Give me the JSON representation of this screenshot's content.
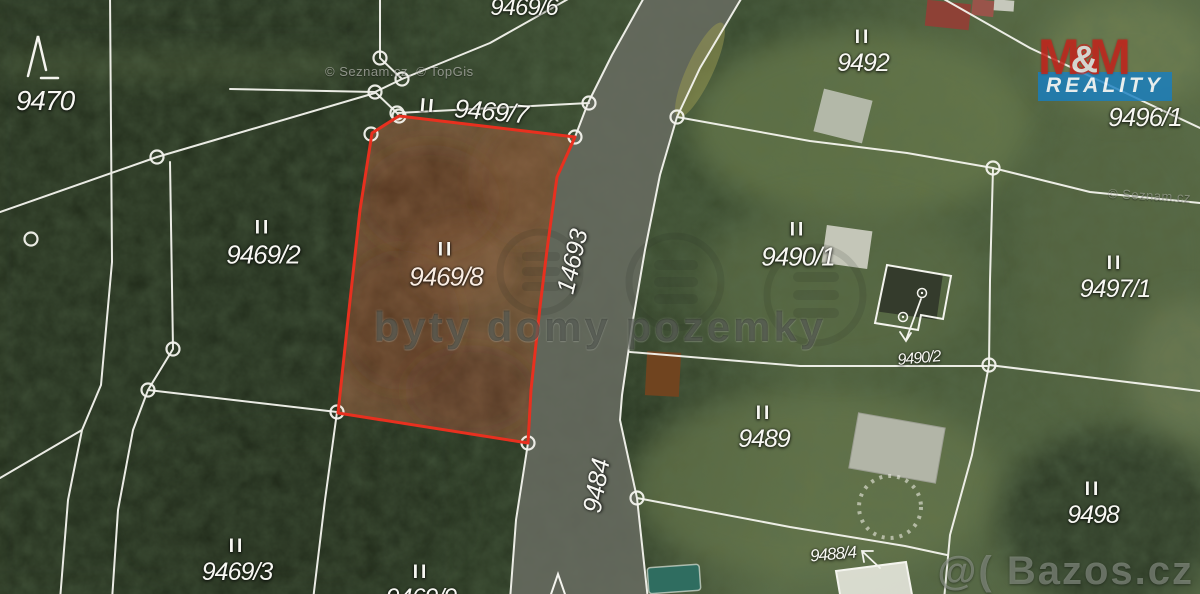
{
  "map": {
    "type": "cadastral-aerial-photo",
    "attribution_left": "© Seznam.cz, © TopGis",
    "attribution_right": "© Seznam.cz",
    "center_watermark": "byty domy pozemky",
    "corner_watermark": "@( Bazos.cz",
    "logo": {
      "m_left": "M",
      "ampersand": "&",
      "m_right": "M",
      "banner": "REALITY"
    },
    "colors": {
      "highlight_stroke": "#e8301f",
      "highlight_fill": "rgba(130,82,52,0.6)",
      "boundary_line": "#f4f4ee",
      "road_surface": "#686c62",
      "logo_red": "#c6241c",
      "logo_blue": "#177ec1"
    },
    "road_labels": [
      {
        "text": "14693"
      },
      {
        "text": "9484"
      }
    ],
    "labels": [
      {
        "marker": "",
        "text": "9470"
      },
      {
        "marker": "",
        "text": "9469/6"
      },
      {
        "marker": "II",
        "text": "9469/7"
      },
      {
        "marker": "II",
        "text": "9469/2"
      },
      {
        "marker": "II",
        "text": "9469/8",
        "highlighted": true
      },
      {
        "marker": "II",
        "text": "9492"
      },
      {
        "marker": "",
        "text": "9496/1"
      },
      {
        "marker": "II",
        "text": "9490/1"
      },
      {
        "marker": "II",
        "text": "9497/1"
      },
      {
        "marker": "",
        "text": "9490/2"
      },
      {
        "marker": "II",
        "text": "9489"
      },
      {
        "marker": "II",
        "text": "9498"
      },
      {
        "marker": "",
        "text": "9488/4"
      },
      {
        "marker": "II",
        "text": "9469/3"
      },
      {
        "marker": "II",
        "text": "9469/9"
      }
    ]
  }
}
